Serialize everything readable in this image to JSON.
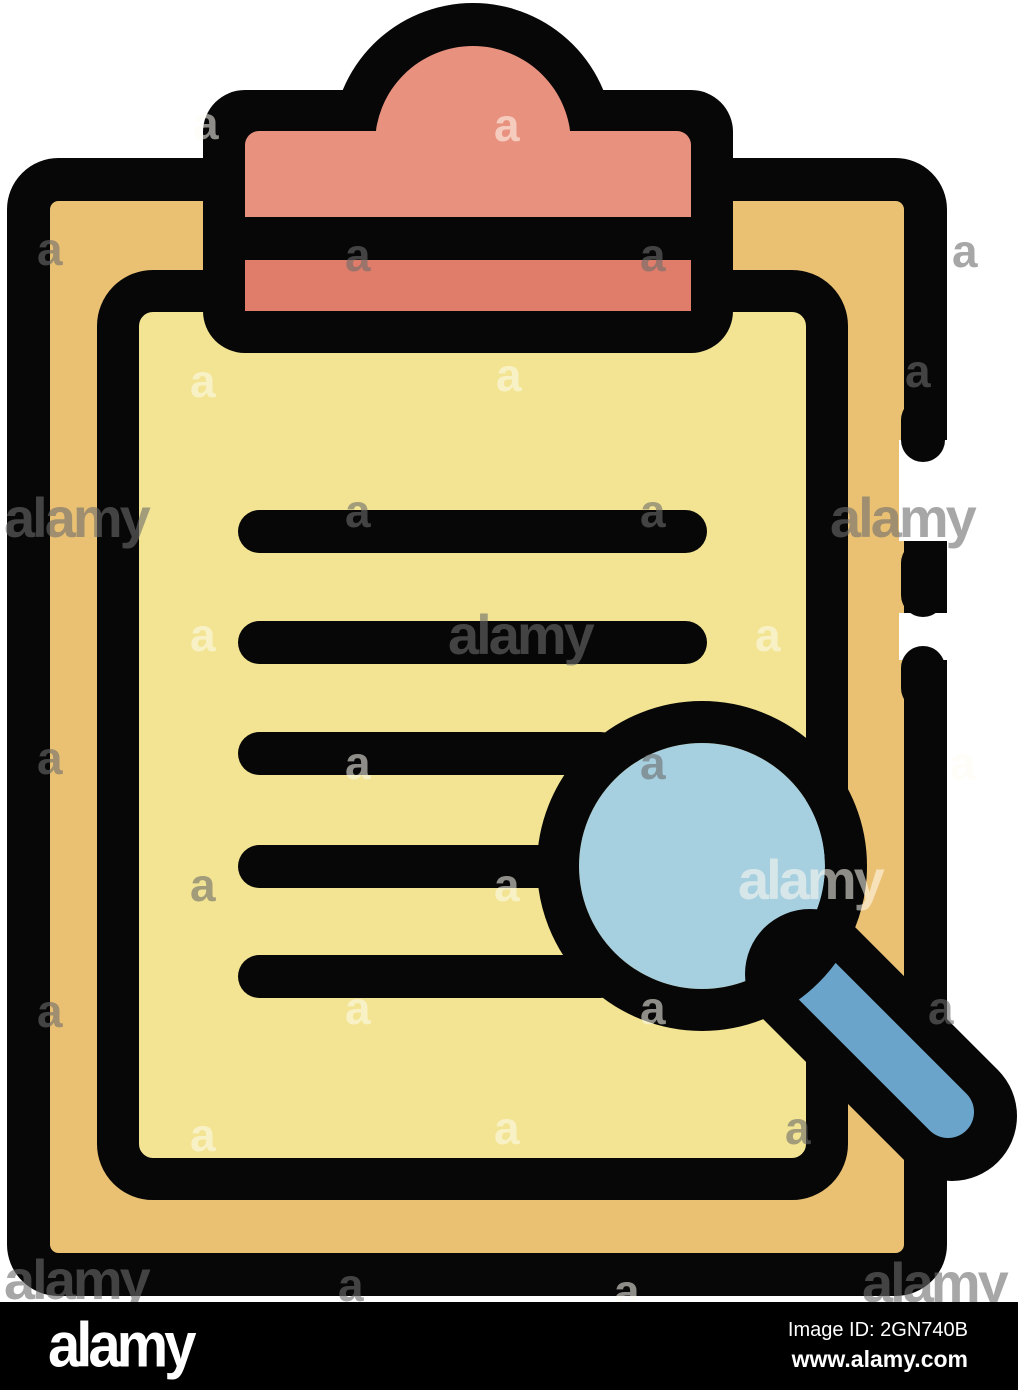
{
  "page": {
    "width": 1018,
    "height": 1390,
    "background": "#ffffff"
  },
  "colors": {
    "background": "#ffffff",
    "outline_black": "#070707",
    "board_tan": "#EAC173",
    "paper_yellow": "#F2E492",
    "clip_salmon": "#E8917F",
    "clip_salmon_dark": "#DF7D6A",
    "lens_blue": "#A6CFE0",
    "handle_blue": "#6BA4CB",
    "watermark_gray": "rgba(108,108,108,0.6)",
    "watermark_light": "rgba(255,252,240,0.55)",
    "footer_bar": "#000000",
    "footer_text": "#ffffff"
  },
  "watermarks": {
    "letter": "a",
    "word": "alamy",
    "items": [
      {
        "x": 193,
        "y": 100,
        "t": "a",
        "c": "l"
      },
      {
        "x": 494,
        "y": 102,
        "t": "a",
        "c": "l"
      },
      {
        "x": 37,
        "y": 226,
        "t": "a",
        "c": "g"
      },
      {
        "x": 345,
        "y": 232,
        "t": "a",
        "c": "g"
      },
      {
        "x": 640,
        "y": 232,
        "t": "a",
        "c": "g"
      },
      {
        "x": 952,
        "y": 228,
        "t": "a",
        "c": "g"
      },
      {
        "x": 190,
        "y": 358,
        "t": "a",
        "c": "l"
      },
      {
        "x": 496,
        "y": 352,
        "t": "a",
        "c": "l"
      },
      {
        "x": 905,
        "y": 348,
        "t": "a",
        "c": "g"
      },
      {
        "x": 4,
        "y": 490,
        "t": "w",
        "c": "g"
      },
      {
        "x": 345,
        "y": 488,
        "t": "a",
        "c": "g"
      },
      {
        "x": 640,
        "y": 488,
        "t": "a",
        "c": "g"
      },
      {
        "x": 830,
        "y": 490,
        "t": "w",
        "c": "g"
      },
      {
        "x": 190,
        "y": 612,
        "t": "a",
        "c": "l"
      },
      {
        "x": 448,
        "y": 607,
        "t": "w",
        "c": "g"
      },
      {
        "x": 755,
        "y": 612,
        "t": "a",
        "c": "l"
      },
      {
        "x": 37,
        "y": 735,
        "t": "a",
        "c": "g"
      },
      {
        "x": 345,
        "y": 740,
        "t": "a",
        "c": "l"
      },
      {
        "x": 640,
        "y": 740,
        "t": "a",
        "c": "g"
      },
      {
        "x": 950,
        "y": 740,
        "t": "a",
        "c": "l"
      },
      {
        "x": 190,
        "y": 862,
        "t": "a",
        "c": "g"
      },
      {
        "x": 494,
        "y": 862,
        "t": "a",
        "c": "l"
      },
      {
        "x": 738,
        "y": 852,
        "t": "w",
        "c": "l"
      },
      {
        "x": 37,
        "y": 988,
        "t": "a",
        "c": "g"
      },
      {
        "x": 345,
        "y": 985,
        "t": "a",
        "c": "l"
      },
      {
        "x": 640,
        "y": 985,
        "t": "a",
        "c": "l"
      },
      {
        "x": 928,
        "y": 985,
        "t": "a",
        "c": "g"
      },
      {
        "x": 190,
        "y": 1112,
        "t": "a",
        "c": "l"
      },
      {
        "x": 494,
        "y": 1105,
        "t": "a",
        "c": "l"
      },
      {
        "x": 785,
        "y": 1105,
        "t": "a",
        "c": "g"
      },
      {
        "x": 4,
        "y": 1252,
        "t": "w",
        "c": "g"
      },
      {
        "x": 338,
        "y": 1262,
        "t": "a",
        "c": "g"
      },
      {
        "x": 614,
        "y": 1268,
        "t": "a",
        "c": "l"
      },
      {
        "x": 862,
        "y": 1255,
        "t": "w",
        "c": "g"
      }
    ]
  },
  "footer": {
    "logo": "alamy",
    "image_id": "Image ID: 2GN740B",
    "website": "www.alamy.com"
  }
}
